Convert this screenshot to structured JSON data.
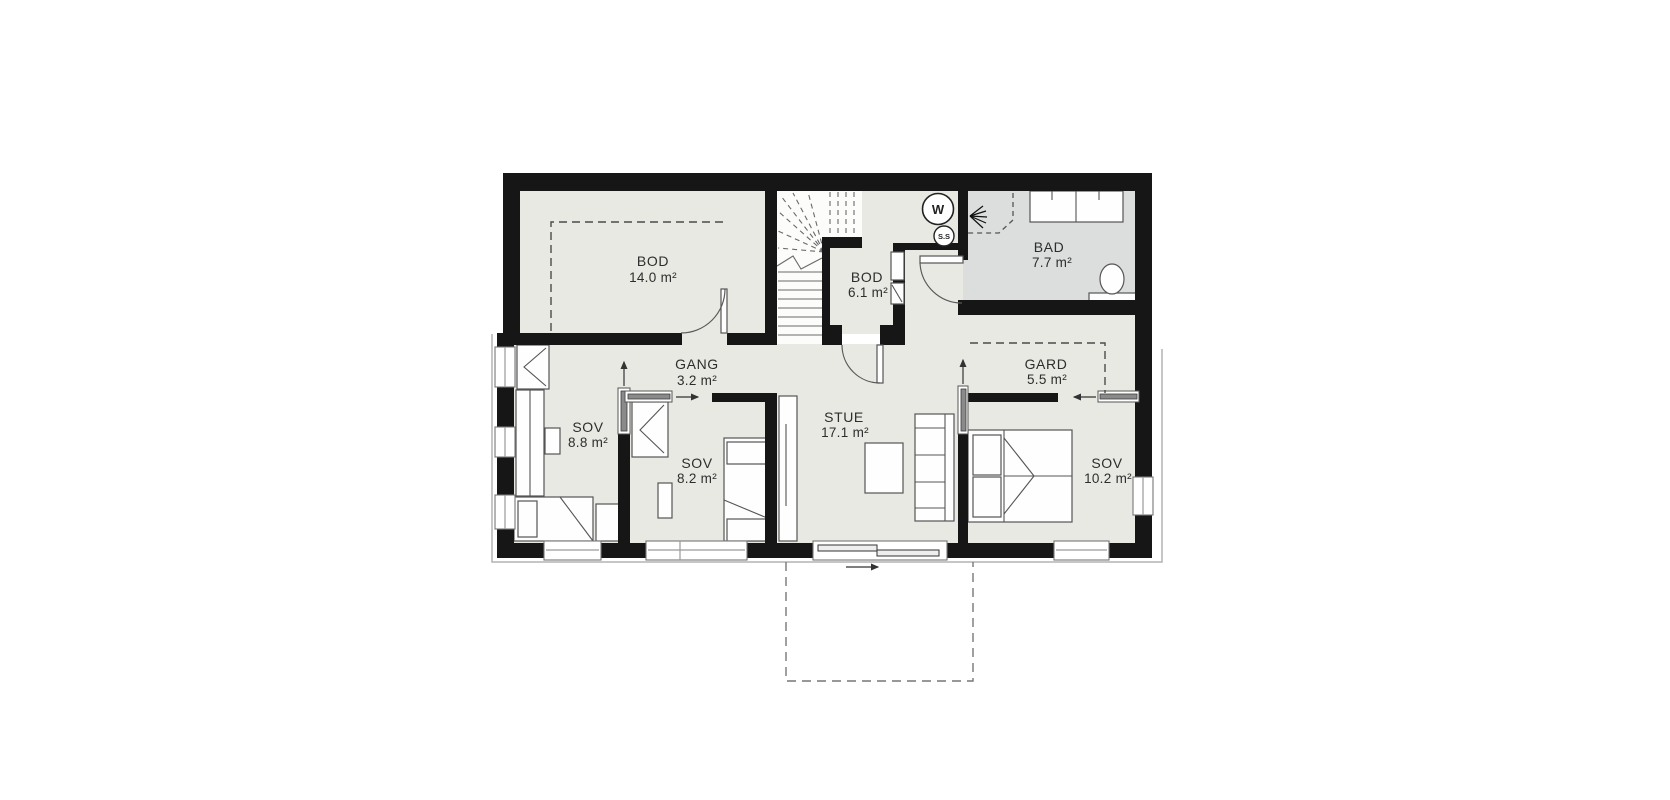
{
  "plan": {
    "kind": "floor-plan",
    "language": "Norwegian"
  },
  "rooms": [
    {
      "label": "BOD",
      "area": "14.0 m²"
    },
    {
      "label": "GANG",
      "area": "3.2 m²"
    },
    {
      "label": "BOD",
      "area": "6.1 m²"
    },
    {
      "label": "BAD",
      "area": "7.7 m²"
    },
    {
      "label": "GARD",
      "area": "5.5 m²"
    },
    {
      "label": "SOV",
      "area": "8.8 m²"
    },
    {
      "label": "SOV",
      "area": "8.2 m²"
    },
    {
      "label": "STUE",
      "area": "17.1 m²"
    },
    {
      "label": "SOV",
      "area": "10.2 m²"
    }
  ],
  "symbols": {
    "w": "W",
    "ss": "S.S"
  },
  "colors": {
    "wall": "#161616",
    "floor": "#e9e9e4",
    "bath_floor": "#dcdddd",
    "furniture_line": "#555555",
    "background": "#ffffff"
  }
}
